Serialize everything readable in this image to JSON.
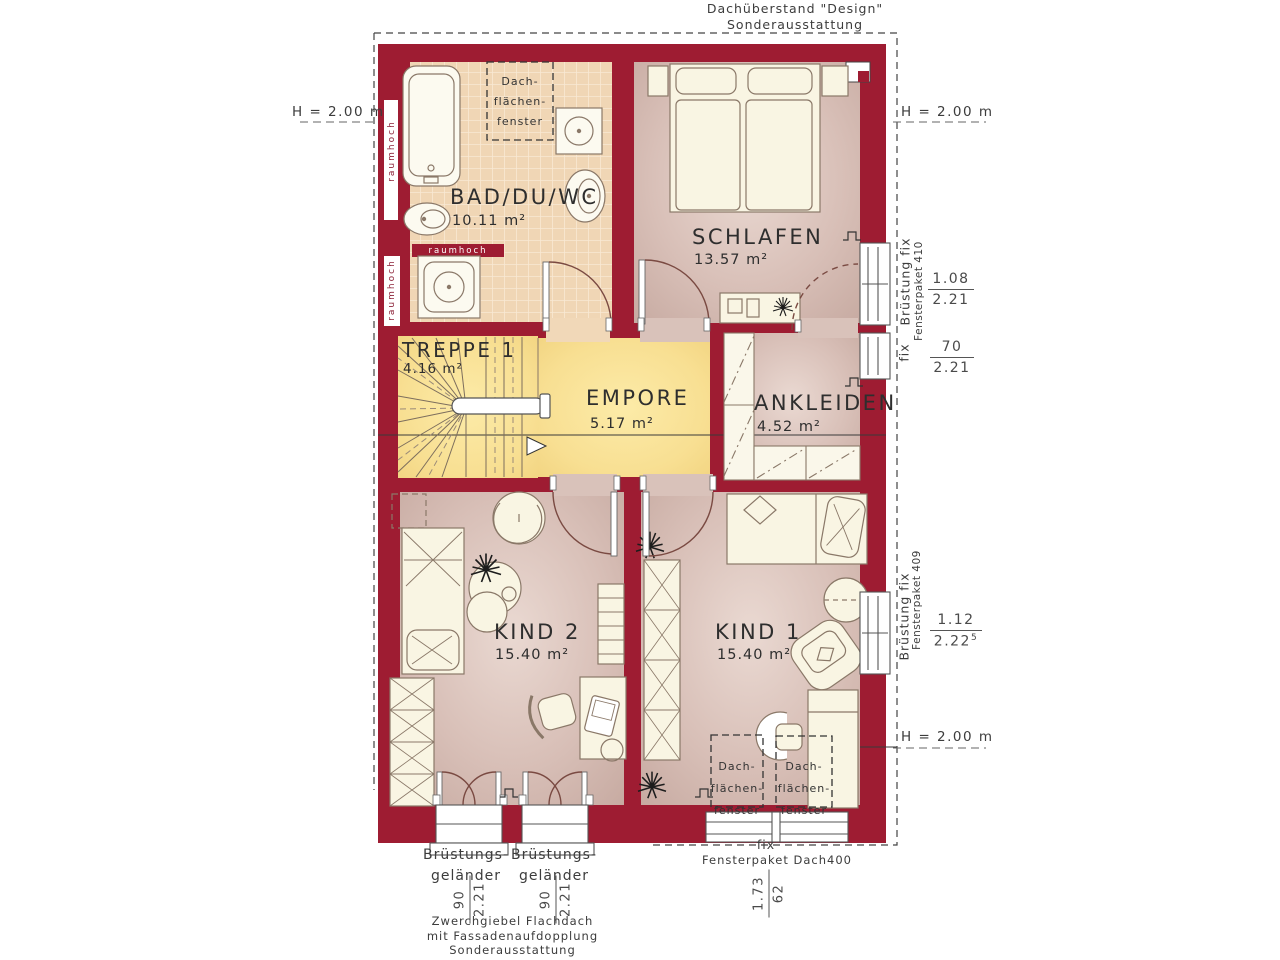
{
  "colors": {
    "wall": "#9e1c32",
    "floor_pink": "#d8bfb7",
    "floor_gold": "#f7dc8e",
    "floor_tile": "#f0d6b5",
    "furniture": "#f9f5e3"
  },
  "rooms": {
    "bad": {
      "name": "BAD/DU/WC",
      "area": "10.11 m²"
    },
    "schlafen": {
      "name": "SCHLAFEN",
      "area": "13.57 m²"
    },
    "treppe": {
      "name": "TREPPE 1",
      "area": "4.16 m²"
    },
    "empore": {
      "name": "EMPORE",
      "area": "5.17 m²"
    },
    "ankleiden": {
      "name": "ANKLEIDEN",
      "area": "4.52 m²"
    },
    "kind2": {
      "name": "KIND 2",
      "area": "15.40 m²"
    },
    "kind1": {
      "name": "KIND 1",
      "area": "15.40 m²"
    }
  },
  "labels": {
    "roof_note_1": "Dachüberstand \"Design\"",
    "roof_note_2": "Sonderausstattung",
    "h_2m": "H = 2.00 m",
    "raumhoch": "raumhoch",
    "skylight_1": "Dach-",
    "skylight_2": "flächen-",
    "skylight_3": "fenster"
  },
  "dimensions": {
    "win410": {
      "parapet": "Brüstung fix",
      "package": "Fensterpaket 410",
      "w1_num": "1.08",
      "w1_den": "2.21",
      "fix": "fix",
      "w2_num": "70",
      "w2_den": "2.21"
    },
    "win409": {
      "parapet": "Brüstung fix",
      "package": "Fensterpaket 409",
      "num": "1.12",
      "den": "2.22",
      "sup": "5"
    },
    "rail_1": "Brüstungs-",
    "rail_2": "geländer",
    "rail_num": "90",
    "rail_den": "2.21",
    "roof_window": {
      "fix": "fix",
      "package": "Fensterpaket Dach400",
      "num": "1.73",
      "den": "62"
    },
    "gable_1": "Zwerchgiebel Flachdach",
    "gable_2": "mit Fassadenaufdopplung",
    "gable_3": "Sonderausstattung"
  }
}
